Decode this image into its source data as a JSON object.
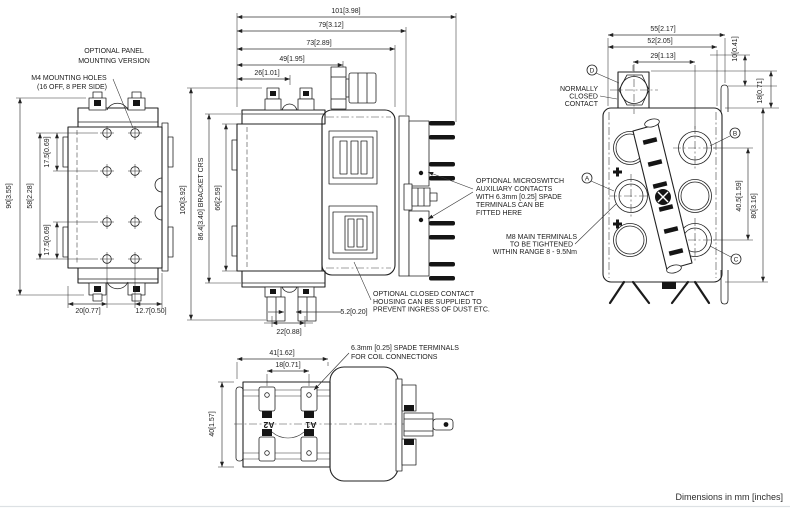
{
  "footer": {
    "note": "Dimensions in mm [inches]"
  },
  "left_view": {
    "title": [
      "OPTIONAL PANEL",
      "MOUNTING VERSION"
    ],
    "m4_note": [
      "M4 MOUNTING HOLES",
      "(16 OFF, 8 PER SIDE)"
    ],
    "dims": {
      "height": "90[3.55]",
      "hole_span": "58[2.28]",
      "hole_pitch_top": "17.5[0.69]",
      "hole_pitch_bottom": "17.5[0.69]",
      "foot_left": "20[0.77]",
      "foot_right": "12.7[0.50]"
    }
  },
  "front_view": {
    "dims": {
      "overall_width": "101[3.98]",
      "bracket_width": "79[3.12]",
      "body_width": "73[2.89]",
      "terminal_stack": "49[1.95]",
      "coil_terminal": "26[1.01]",
      "overall_height": "100[3.92]",
      "bracket_crs": "86.4[3.40] BRACKET CRS",
      "body_height": "66[2.59]",
      "blade_gap": "5.2[0.20]",
      "blade_pitch": "22[0.88]"
    },
    "microswitch_note": [
      "OPTIONAL MICROSWITCH",
      "AUXILIARY CONTACTS",
      "WITH 6.3mm [0.25] SPADE",
      "TERMINALS CAN BE",
      "FITTED HERE"
    ],
    "m8_note": [
      "M8 MAIN TERMINALS",
      "TO BE TIGHTENED",
      "WITHIN RANGE 8 - 9.5Nm"
    ],
    "housing_note": [
      "OPTIONAL CLOSED CONTACT",
      "HOUSING CAN BE SUPPLIED TO",
      "PREVENT INGRESS OF DUST ETC."
    ]
  },
  "side_view": {
    "nc_note": [
      "NORMALLY",
      "CLOSED",
      "CONTACT"
    ],
    "dims": {
      "overall_width": "55[2.17]",
      "inner_width": "52[2.05]",
      "contact_pitch": "29[1.13]",
      "top_offset": "10[0.41]",
      "nc_height": "18[0.71]",
      "terminal_pitch": "40.5[1.59]",
      "height": "80[3.16]"
    },
    "terminal_labels": {
      "a": "A",
      "b": "B",
      "c": "C",
      "d": "D"
    }
  },
  "bottom_view": {
    "dims": {
      "width": "41[1.62]",
      "terminal_pitch": "18[0.71]",
      "height": "40[1.57]"
    },
    "spade_note": [
      "6.3mm [0.25] SPADE TERMINALS",
      "FOR COIL CONNECTIONS"
    ],
    "coil_terminals": {
      "a2": "A2",
      "a1": "A1"
    }
  }
}
